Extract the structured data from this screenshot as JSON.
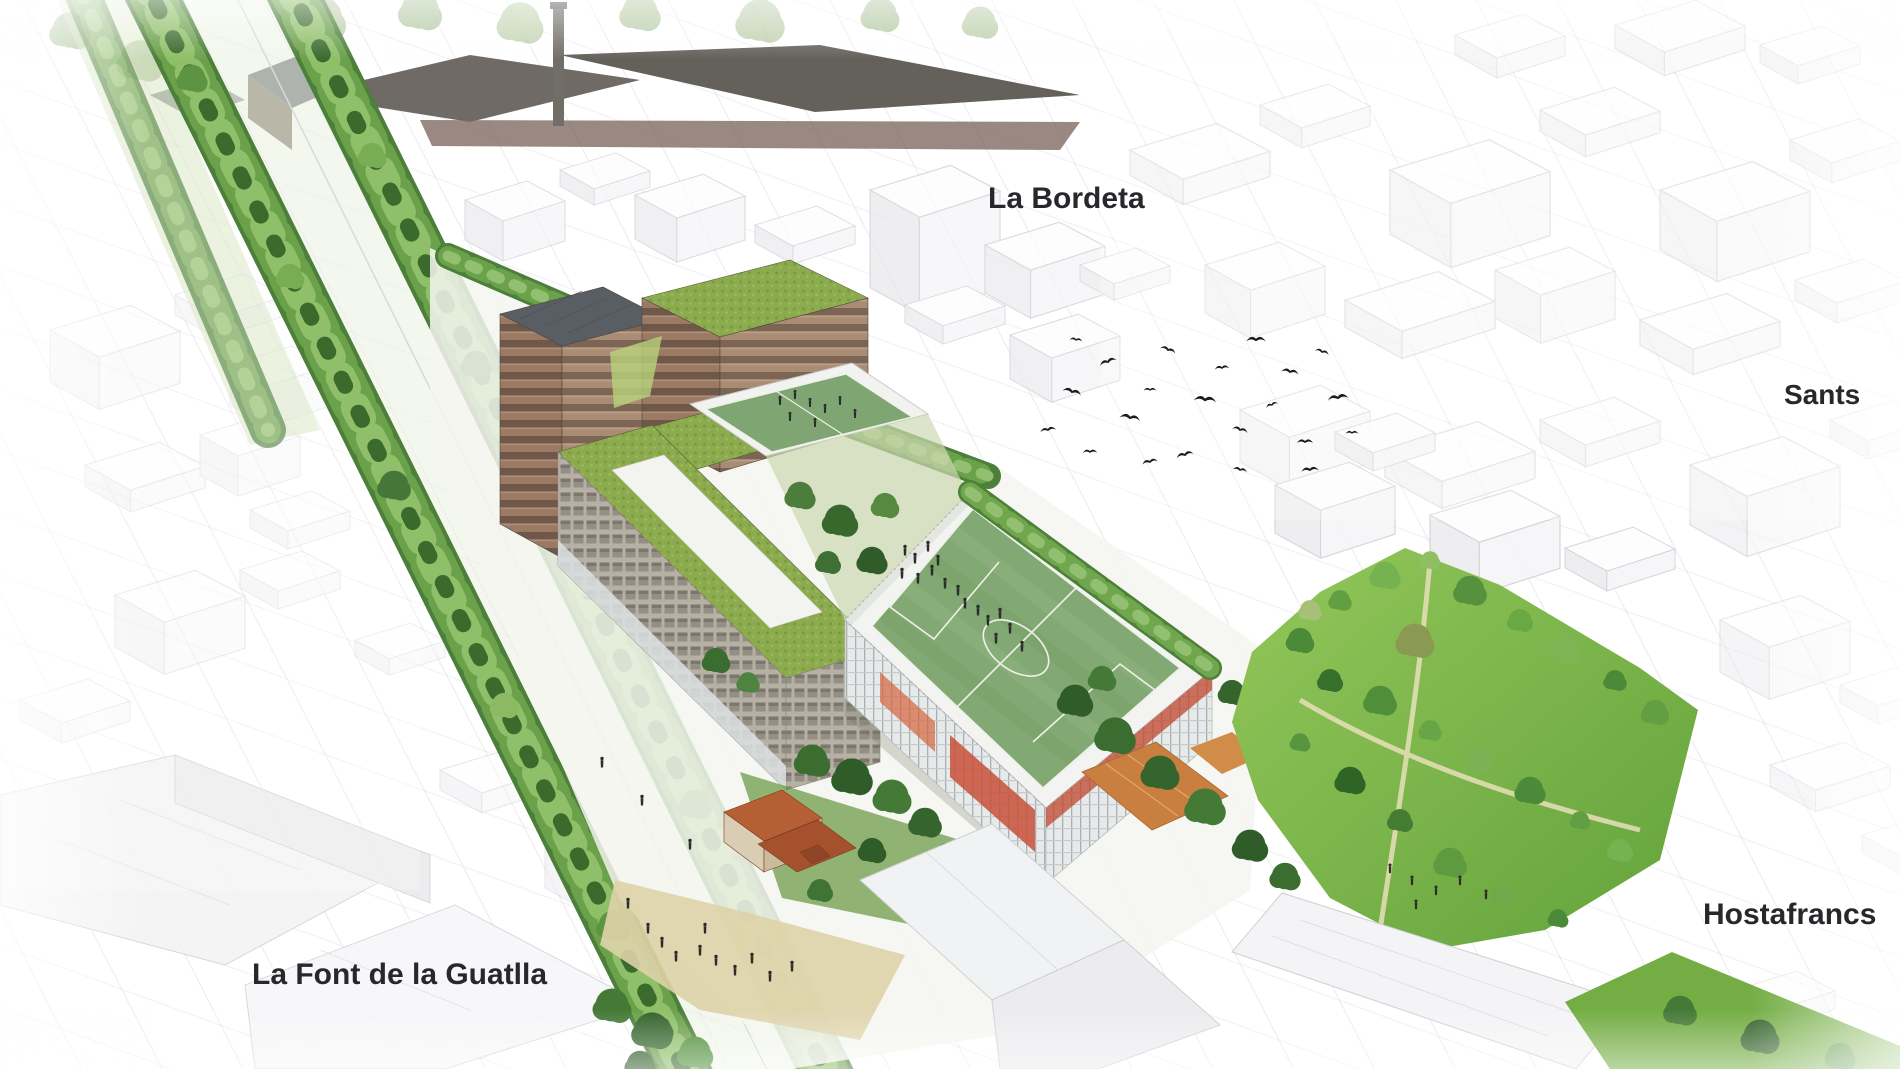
{
  "labels": {
    "la_bordeta": "La Bordeta",
    "sants": "Sants",
    "hostafrancs": "Hostafrancs",
    "la_font_de_la_guatlla": "La Font de la Guatlla"
  },
  "palette": {
    "background_city_line": "#cdced4",
    "avenue_tree_green": "#6ca14c",
    "green_roof": "#8cab4e",
    "pitch_green": "#82a873",
    "park_lawn_green": "#7dba4b",
    "facade_brown": "#9b7a63",
    "tower_roof_gray": "#595d64",
    "masia_roof_terracotta": "#b55f35",
    "clay_court_orange": "#c97f3f",
    "podium_white": "#f3f4f1",
    "red_facade_accent": "#c24d36",
    "bird_black": "#1b1b1b",
    "label_text": "#28282c"
  }
}
